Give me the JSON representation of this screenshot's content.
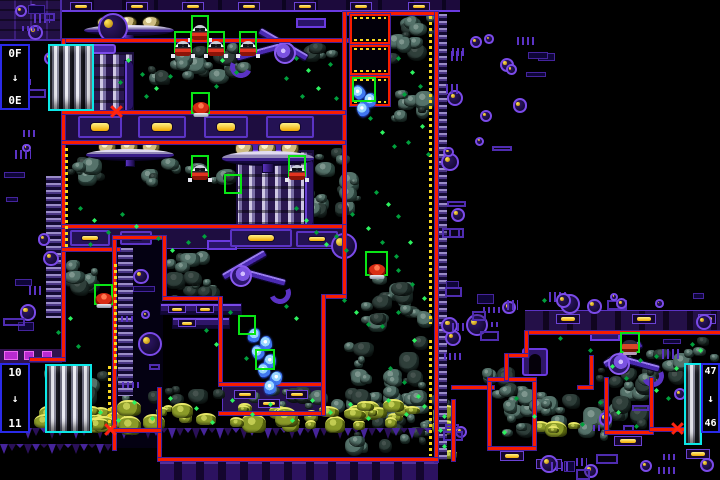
{
  "ui": {
    "arrow_glyph": "↓"
  },
  "colors": {
    "border_red": "#f81c00",
    "border_purple": "#44209a",
    "selection_green": "#09e515",
    "elevator_cyan": "#0ce8e8",
    "label_blue": "#2a2ae8",
    "lamp_yellow": "#f8d820",
    "sparkle_green": "#2df25f",
    "crystal_blue": "#4078f0",
    "rock_teal": "#55726a",
    "moss_olive": "#8a9a28"
  },
  "elevators": [
    {
      "top_label": "0F",
      "bottom_label": "0E",
      "box": [
        0,
        44,
        30,
        66
      ],
      "tube": [
        48,
        44,
        46,
        67
      ],
      "side": "left"
    },
    {
      "top_label": "10",
      "bottom_label": "11",
      "box": [
        0,
        363,
        30,
        70
      ],
      "tube": [
        45,
        364,
        47,
        69
      ],
      "side": "left"
    },
    {
      "top_label": "47",
      "bottom_label": "46",
      "box": [
        701,
        363,
        19,
        70
      ],
      "tube": [
        684,
        363,
        18,
        82
      ],
      "side": "right"
    }
  ],
  "regions": [
    [
      "tech-block",
      0,
      0,
      62,
      41
    ],
    [
      "ceiling",
      62,
      0,
      398,
      12
    ],
    [
      "band",
      62,
      113,
      283,
      28
    ],
    [
      "band",
      62,
      227,
      283,
      22
    ],
    [
      "band-dark",
      0,
      349,
      62,
      14
    ],
    [
      "block",
      222,
      385,
      100,
      27
    ],
    [
      "corridor-band",
      525,
      310,
      195,
      21
    ],
    [
      "bottom-band",
      160,
      461,
      278,
      19
    ],
    [
      "column-int",
      116,
      239,
      47,
      209
    ]
  ],
  "rungs": [
    [
      46,
      176,
      16,
      142
    ],
    [
      118,
      248,
      15,
      148
    ],
    [
      438,
      14,
      9,
      446
    ]
  ],
  "borders": [
    [
      62,
      39,
      286,
      3
    ],
    [
      345,
      12,
      92,
      3
    ],
    [
      343,
      12,
      3,
      216
    ],
    [
      435,
      12,
      3,
      450
    ],
    [
      62,
      39,
      3,
      322
    ],
    [
      30,
      358,
      35,
      3
    ],
    [
      62,
      111,
      283,
      3
    ],
    [
      62,
      141,
      283,
      3
    ],
    [
      62,
      225,
      283,
      3
    ],
    [
      62,
      248,
      58,
      3
    ],
    [
      113,
      236,
      3,
      214
    ],
    [
      113,
      236,
      53,
      3
    ],
    [
      163,
      236,
      3,
      64
    ],
    [
      163,
      297,
      59,
      3
    ],
    [
      219,
      297,
      3,
      89
    ],
    [
      219,
      383,
      106,
      3
    ],
    [
      219,
      412,
      106,
      3
    ],
    [
      343,
      225,
      3,
      73
    ],
    [
      322,
      295,
      24,
      3
    ],
    [
      322,
      295,
      3,
      120
    ],
    [
      158,
      388,
      3,
      73
    ],
    [
      113,
      429,
      48,
      3
    ],
    [
      158,
      458,
      280,
      3
    ],
    [
      452,
      400,
      3,
      61
    ],
    [
      452,
      386,
      42,
      3
    ],
    [
      488,
      378,
      3,
      72
    ],
    [
      533,
      378,
      3,
      72
    ],
    [
      488,
      378,
      48,
      3
    ],
    [
      488,
      447,
      48,
      3
    ],
    [
      525,
      331,
      195,
      3
    ],
    [
      525,
      331,
      3,
      26
    ],
    [
      505,
      354,
      23,
      3
    ],
    [
      505,
      354,
      3,
      26
    ],
    [
      590,
      356,
      3,
      32
    ],
    [
      578,
      386,
      15,
      3
    ],
    [
      605,
      378,
      3,
      56
    ],
    [
      650,
      378,
      3,
      56
    ],
    [
      605,
      431,
      48,
      3
    ],
    [
      650,
      428,
      36,
      3
    ]
  ],
  "yellow_strips": [
    [
      429,
      16,
      3,
      308
    ],
    [
      429,
      340,
      3,
      116
    ],
    [
      65,
      148,
      3,
      100
    ],
    [
      114,
      264,
      3,
      108
    ],
    [
      108,
      366,
      3,
      62
    ]
  ],
  "door_frames": [
    [
      350,
      14,
      40,
      30
    ],
    [
      350,
      45,
      40,
      30
    ],
    [
      350,
      76,
      40,
      30
    ]
  ],
  "saucers": [
    [
      84,
      16,
      90,
      26
    ],
    [
      86,
      140,
      88,
      27
    ],
    [
      222,
      140,
      92,
      33
    ]
  ],
  "towers": [
    [
      74,
      52,
      60,
      61
    ],
    [
      236,
      150,
      78,
      79
    ]
  ],
  "claws": [
    [
      228,
      18,
      102,
      66,
      0
    ],
    [
      203,
      240,
      90,
      70,
      1
    ],
    [
      586,
      331,
      80,
      62,
      1
    ]
  ],
  "rock_clusters": [
    [
      63,
      42,
      34,
      34
    ],
    [
      148,
      40,
      104,
      52
    ],
    [
      300,
      42,
      46,
      26
    ],
    [
      362,
      14,
      74,
      58
    ],
    [
      388,
      86,
      48,
      46
    ],
    [
      63,
      154,
      56,
      34
    ],
    [
      140,
      158,
      124,
      32
    ],
    [
      302,
      146,
      60,
      86
    ],
    [
      63,
      246,
      44,
      58
    ],
    [
      162,
      243,
      64,
      62
    ],
    [
      358,
      272,
      78,
      62
    ],
    [
      343,
      336,
      92,
      120
    ],
    [
      40,
      366,
      102,
      42
    ],
    [
      140,
      386,
      318,
      28
    ],
    [
      476,
      366,
      58,
      22
    ],
    [
      490,
      382,
      60,
      62
    ],
    [
      606,
      380,
      44,
      50
    ],
    [
      596,
      350,
      58,
      40
    ],
    [
      634,
      348,
      60,
      48
    ],
    [
      528,
      392,
      84,
      50
    ],
    [
      684,
      336,
      36,
      30
    ]
  ],
  "moss_clusters": [
    [
      30,
      398,
      114,
      32
    ],
    [
      142,
      402,
      204,
      28
    ],
    [
      344,
      398,
      112,
      30
    ],
    [
      432,
      402,
      26,
      60
    ],
    [
      60,
      410,
      64,
      22
    ],
    [
      528,
      420,
      56,
      16
    ]
  ],
  "spike_strips": [
    [
      24,
      428,
      420,
      13
    ],
    [
      0,
      444,
      116,
      12
    ]
  ],
  "markers": [
    [
      191,
      15,
      18,
      22,
      "hopper"
    ],
    [
      174,
      31,
      18,
      22,
      "hopper"
    ],
    [
      207,
      31,
      18,
      22,
      "hopper"
    ],
    [
      239,
      31,
      18,
      22,
      "hopper"
    ],
    [
      191,
      92,
      19,
      22,
      "frog"
    ],
    [
      191,
      155,
      18,
      22,
      "hopper"
    ],
    [
      288,
      155,
      18,
      22,
      "hopper"
    ],
    [
      224,
      174,
      18,
      20,
      ""
    ],
    [
      352,
      77,
      24,
      25,
      ""
    ],
    [
      94,
      284,
      19,
      21,
      "frog"
    ],
    [
      365,
      251,
      23,
      25,
      "frog"
    ],
    [
      238,
      315,
      18,
      20,
      ""
    ],
    [
      255,
      349,
      20,
      21,
      ""
    ],
    [
      620,
      332,
      20,
      21,
      "crab"
    ]
  ],
  "crystals": [
    [
      353,
      85
    ],
    [
      364,
      93
    ],
    [
      357,
      102
    ],
    [
      248,
      328
    ],
    [
      260,
      336
    ],
    [
      252,
      345
    ],
    [
      264,
      354
    ],
    [
      258,
      363
    ],
    [
      270,
      371
    ],
    [
      264,
      380
    ]
  ],
  "x_marks": [
    [
      110,
      105
    ],
    [
      104,
      423
    ],
    [
      671,
      422
    ]
  ],
  "sparkles": [
    [
      128,
      60,
      1
    ],
    [
      142,
      74,
      0
    ],
    [
      156,
      88,
      1
    ],
    [
      170,
      76,
      0
    ],
    [
      146,
      96,
      0
    ],
    [
      120,
      82,
      0
    ],
    [
      222,
      60,
      1
    ],
    [
      236,
      72,
      0
    ],
    [
      216,
      86,
      0
    ],
    [
      296,
      58,
      0
    ],
    [
      308,
      70,
      1
    ],
    [
      286,
      78,
      0
    ],
    [
      330,
      64,
      0
    ],
    [
      318,
      88,
      1
    ],
    [
      302,
      96,
      0
    ],
    [
      336,
      98,
      0
    ],
    [
      398,
      58,
      0
    ],
    [
      412,
      72,
      1
    ],
    [
      404,
      94,
      0
    ],
    [
      420,
      86,
      0
    ],
    [
      370,
      118,
      0
    ],
    [
      382,
      132,
      1
    ],
    [
      394,
      146,
      0
    ],
    [
      408,
      142,
      0
    ],
    [
      422,
      126,
      1
    ],
    [
      428,
      154,
      0
    ],
    [
      80,
      208,
      0
    ],
    [
      94,
      220,
      1
    ],
    [
      108,
      232,
      0
    ],
    [
      122,
      214,
      0
    ],
    [
      136,
      226,
      1
    ],
    [
      90,
      244,
      0
    ],
    [
      158,
      238,
      0
    ],
    [
      172,
      250,
      1
    ],
    [
      188,
      242,
      0
    ],
    [
      204,
      236,
      0
    ],
    [
      296,
      208,
      0
    ],
    [
      306,
      220,
      1
    ],
    [
      316,
      232,
      0
    ],
    [
      326,
      244,
      1
    ],
    [
      336,
      236,
      0
    ],
    [
      346,
      250,
      0
    ],
    [
      376,
      192,
      0
    ],
    [
      388,
      204,
      1
    ],
    [
      398,
      216,
      0
    ],
    [
      70,
      318,
      1
    ],
    [
      58,
      332,
      0
    ],
    [
      78,
      346,
      0
    ],
    [
      206,
      330,
      0
    ],
    [
      216,
      344,
      1
    ],
    [
      230,
      312,
      0
    ],
    [
      286,
      306,
      0
    ],
    [
      296,
      318,
      1
    ],
    [
      246,
      358,
      0
    ],
    [
      344,
      300,
      0
    ],
    [
      356,
      312,
      1
    ],
    [
      368,
      324,
      0
    ],
    [
      352,
      214,
      0
    ],
    [
      368,
      228,
      1
    ],
    [
      382,
      242,
      0
    ],
    [
      396,
      256,
      0
    ],
    [
      410,
      242,
      1
    ],
    [
      398,
      270,
      0
    ],
    [
      412,
      284,
      0
    ],
    [
      424,
      298,
      1
    ],
    [
      398,
      312,
      0
    ],
    [
      382,
      326,
      0
    ],
    [
      414,
      340,
      1
    ],
    [
      390,
      368,
      0
    ],
    [
      404,
      382,
      0
    ],
    [
      418,
      396,
      1
    ],
    [
      70,
      400,
      1
    ],
    [
      100,
      412,
      1
    ],
    [
      134,
      402,
      1
    ],
    [
      152,
      418,
      1
    ],
    [
      170,
      398,
      1
    ],
    [
      196,
      408,
      1
    ],
    [
      212,
      422,
      1
    ],
    [
      232,
      400,
      1
    ],
    [
      252,
      414,
      1
    ],
    [
      270,
      404,
      1
    ],
    [
      292,
      420,
      1
    ],
    [
      312,
      400,
      1
    ],
    [
      330,
      412,
      1
    ],
    [
      350,
      404,
      1
    ],
    [
      368,
      418,
      1
    ],
    [
      388,
      400,
      1
    ],
    [
      406,
      414,
      1
    ],
    [
      424,
      406,
      1
    ],
    [
      444,
      416,
      1
    ],
    [
      58,
      414,
      1
    ],
    [
      86,
      424,
      1
    ],
    [
      118,
      420,
      1
    ],
    [
      440,
      430,
      1
    ],
    [
      444,
      446,
      1
    ],
    [
      612,
      366,
      1
    ],
    [
      626,
      378,
      0
    ],
    [
      640,
      360,
      0
    ],
    [
      656,
      390,
      1
    ],
    [
      600,
      402,
      0
    ],
    [
      590,
      350,
      0
    ],
    [
      700,
      350,
      1
    ],
    [
      534,
      416,
      1
    ],
    [
      516,
      398,
      0
    ],
    [
      504,
      432,
      1
    ],
    [
      582,
      424,
      0
    ],
    [
      618,
      412,
      1
    ],
    [
      636,
      426,
      0
    ],
    [
      668,
      398,
      0
    ],
    [
      692,
      344,
      0
    ],
    [
      656,
      356,
      0
    ],
    [
      676,
      368,
      1
    ],
    [
      544,
      300,
      0
    ],
    [
      560,
      338,
      0
    ]
  ],
  "props": [
    [
      "clamp",
      70,
      2,
      22,
      9
    ],
    [
      "clamp",
      126,
      2,
      22,
      9
    ],
    [
      "clamp",
      182,
      2,
      22,
      9
    ],
    [
      "clamp",
      238,
      2,
      22,
      9
    ],
    [
      "clamp",
      294,
      2,
      22,
      9
    ],
    [
      "clamp",
      350,
      2,
      22,
      9
    ],
    [
      "clamp",
      408,
      2,
      22,
      9
    ],
    [
      "machine",
      78,
      116,
      44,
      22
    ],
    [
      "machine",
      138,
      116,
      48,
      22
    ],
    [
      "machine",
      204,
      116,
      44,
      22
    ],
    [
      "machine",
      266,
      116,
      48,
      22
    ],
    [
      "machine",
      70,
      230,
      40,
      16
    ],
    [
      "machine",
      120,
      231,
      32,
      14
    ],
    [
      "machine",
      230,
      229,
      62,
      18
    ],
    [
      "machine",
      296,
      231,
      42,
      16
    ],
    [
      "bar",
      160,
      303,
      82,
      12
    ],
    [
      "bar",
      172,
      317,
      58,
      12
    ],
    [
      "lampbox",
      168,
      305,
      18,
      8
    ],
    [
      "lampbox",
      196,
      305,
      18,
      8
    ],
    [
      "lampbox",
      178,
      319,
      18,
      8
    ],
    [
      "lampbox",
      234,
      390,
      22,
      9
    ],
    [
      "lampbox",
      286,
      390,
      22,
      9
    ],
    [
      "lampbox",
      258,
      399,
      22,
      9
    ],
    [
      "lampbox",
      556,
      314,
      24,
      10
    ],
    [
      "lampbox",
      632,
      314,
      24,
      10
    ],
    [
      "lampbox",
      698,
      314,
      18,
      10
    ],
    [
      "lampbox",
      536,
      459,
      26,
      10
    ],
    [
      "lampbox",
      614,
      436,
      28,
      10
    ],
    [
      "lampbox",
      686,
      449,
      24,
      10
    ],
    [
      "lampbox",
      500,
      451,
      24,
      10
    ],
    [
      "mblock",
      4,
      351,
      14,
      9
    ],
    [
      "mblock",
      24,
      351,
      10,
      9
    ],
    [
      "mblock",
      42,
      351,
      10,
      9
    ],
    [
      "arch",
      522,
      348,
      26,
      28
    ],
    [
      "orb",
      331,
      233,
      26,
      26
    ],
    [
      "orb",
      138,
      332,
      24,
      24
    ],
    [
      "orb",
      98,
      13,
      30,
      30
    ],
    [
      "orb",
      466,
      314,
      22,
      22
    ],
    [
      "orb",
      560,
      294,
      20,
      20
    ],
    [
      "orb",
      696,
      314,
      16,
      16
    ],
    [
      "orb",
      674,
      388,
      12,
      12
    ],
    [
      "orb",
      584,
      464,
      14,
      14
    ],
    [
      "orb",
      640,
      460,
      12,
      12
    ],
    [
      "orb",
      700,
      458,
      14,
      14
    ],
    [
      "orb",
      447,
      90,
      16,
      16
    ],
    [
      "orb",
      451,
      208,
      14,
      14
    ],
    [
      "orb",
      445,
      330,
      16,
      16
    ],
    [
      "orb",
      455,
      426,
      12,
      12
    ],
    [
      "orb",
      470,
      36,
      12,
      12
    ],
    [
      "orb",
      500,
      58,
      14,
      14
    ],
    [
      "orb",
      480,
      110,
      12,
      12
    ]
  ],
  "doodad_regions": [
    [
      2,
      44,
      58,
      296,
      16
    ],
    [
      440,
      16,
      26,
      440,
      15
    ],
    [
      468,
      2,
      92,
      156,
      9
    ],
    [
      462,
      288,
      60,
      104,
      7
    ],
    [
      546,
      289,
      172,
      20,
      8
    ],
    [
      480,
      450,
      236,
      28,
      8
    ],
    [
      6,
      4,
      52,
      34,
      7
    ],
    [
      586,
      394,
      66,
      40,
      4
    ],
    [
      660,
      338,
      24,
      24,
      2
    ],
    [
      120,
      250,
      40,
      150,
      6
    ]
  ]
}
